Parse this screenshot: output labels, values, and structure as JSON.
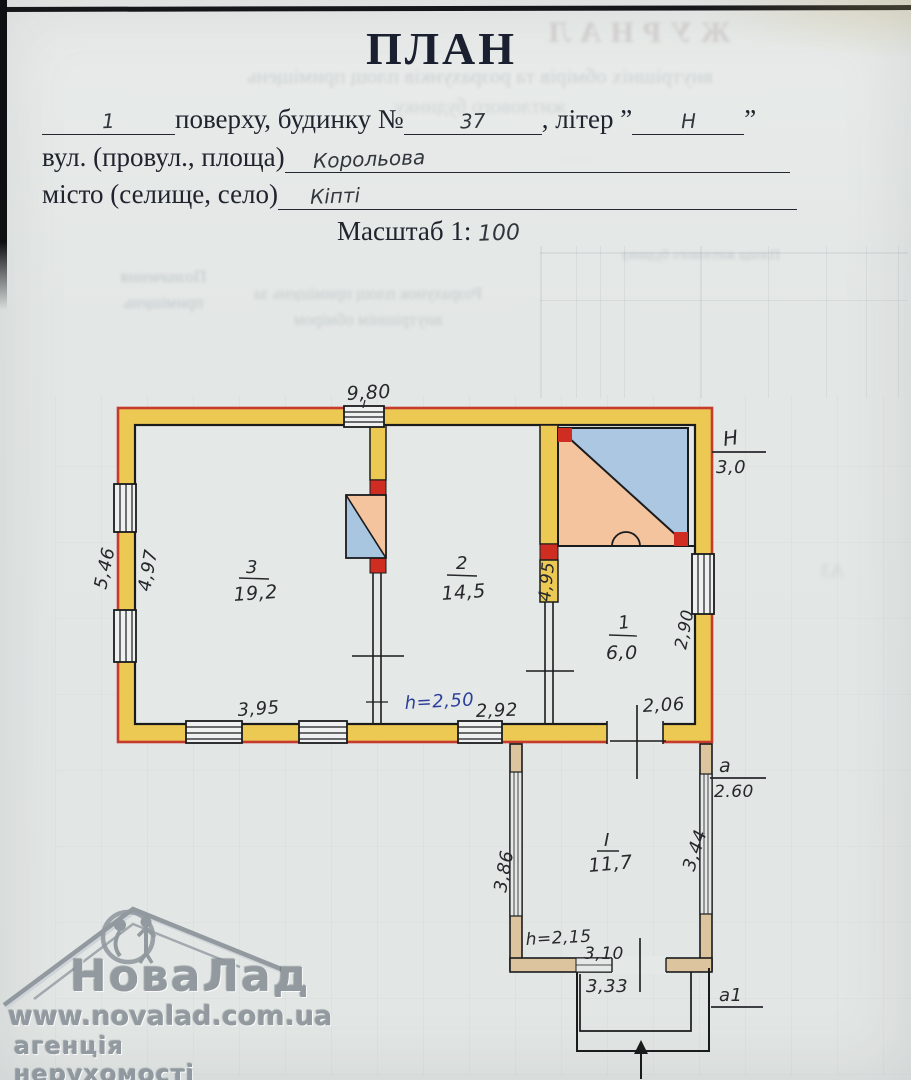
{
  "form": {
    "title": "ПЛАН",
    "floor_value": "1",
    "floor_suffix": "поверху,  будинку №",
    "house_number": "37",
    "letter_label": ", літер ”",
    "letter_value": "Н",
    "closing_quote": "”",
    "street_label": "вул. (провул., площа)",
    "street_value": "Корольова",
    "city_label": "місто (селище, село)",
    "city_value": "Кіпті",
    "scale_label": "Масштаб 1:",
    "scale_value": "100"
  },
  "plan": {
    "main": {
      "dim_top": "9,80",
      "dim_left_outer": "5,46",
      "dim_left_inner": "4,97",
      "room3_number": "3",
      "room3_area": "19,2",
      "room2_number": "2",
      "room2_area": "14,5",
      "room1_number": "1",
      "room1_area": "6,0",
      "dim_partition": "4,95",
      "dim_room1_side": "2,90",
      "height_mark_letter": "Н",
      "height_mark_value": "3,0",
      "dim_bottom_left": "3,95",
      "room_height": "h=2,50",
      "dim_bottom_mid": "2,92",
      "dim_bottom_right": "2,06"
    },
    "annex": {
      "room_number": "I",
      "room_area": "11,7",
      "dim_left": "3,86",
      "dim_right": "3,44",
      "mark_letter": "а",
      "mark_value": "2.60",
      "room_height": "h=2,15",
      "dim_inner": "3,10",
      "dim_outer": "3,33",
      "porch_mark": "а1"
    }
  },
  "watermark": {
    "brand": "НоваЛад",
    "url": "www.novalad.com.ua",
    "tagline": "агенція нерухомості"
  },
  "bleed": {
    "journal": "ЖУРНАЛ",
    "subtitle1": "внутрішніх обмірів та розрахунків площ приміщень",
    "subtitle2": "житлового будинку",
    "col1": "Позначення приміщень",
    "col2": "Розрахунок площ приміщень за внутрішнім обміром",
    "col3": "Площа житлового будинку"
  }
}
